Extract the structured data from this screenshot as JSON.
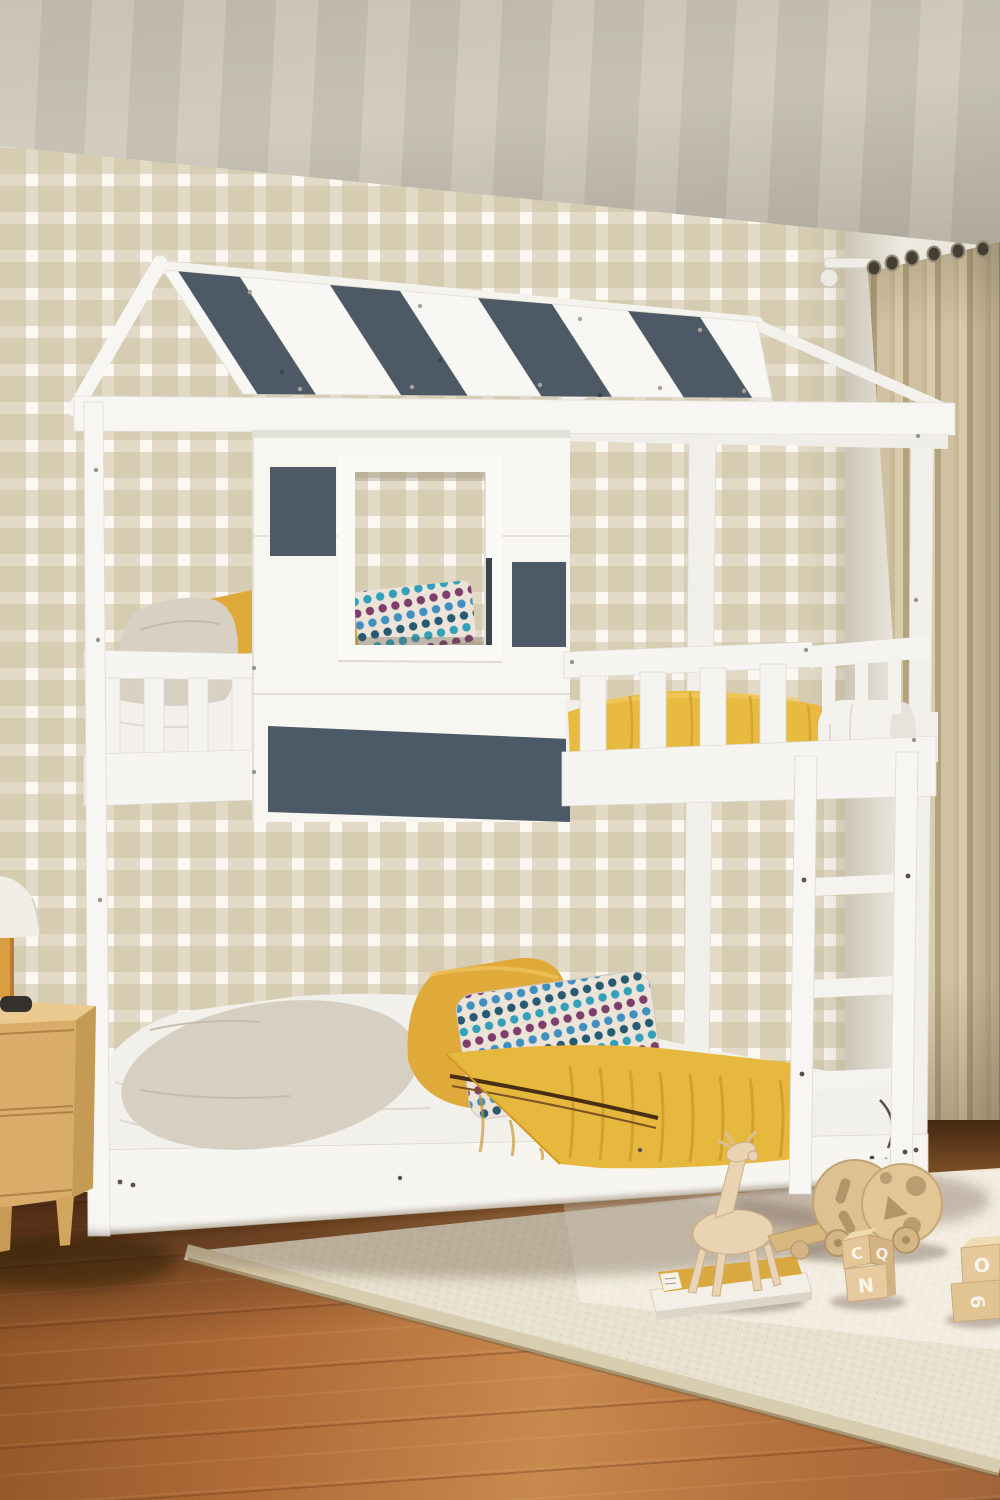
{
  "scene": {
    "description": "Kids house-frame twin-over-twin bunk bed with white wood frame, slate-gray roof stripes and accent panels, striped-roof playhouse top, yellow and polka-dot bedding, beige gingham wallpaper, tan curtain, wood floor, cream rug, wooden nightstand with lamp, and wooden toys",
    "palette": {
      "frame_white": "#f6f5f1",
      "accent_slate": "#4d5a66",
      "bedding_yellow": "#e7b83e",
      "wallpaper_beige": "#cbbf9f",
      "curtain_tan": "#c8b997",
      "floor_wood": "#b5713d",
      "rug_cream": "#e8e1cf",
      "nightstand_wood": "#d9ad69",
      "polka_teal": "#33a0ba",
      "polka_purple": "#7d3e6b"
    },
    "toy_blocks": {
      "letters": [
        "C",
        "Q",
        "N",
        "O",
        "6"
      ]
    }
  }
}
